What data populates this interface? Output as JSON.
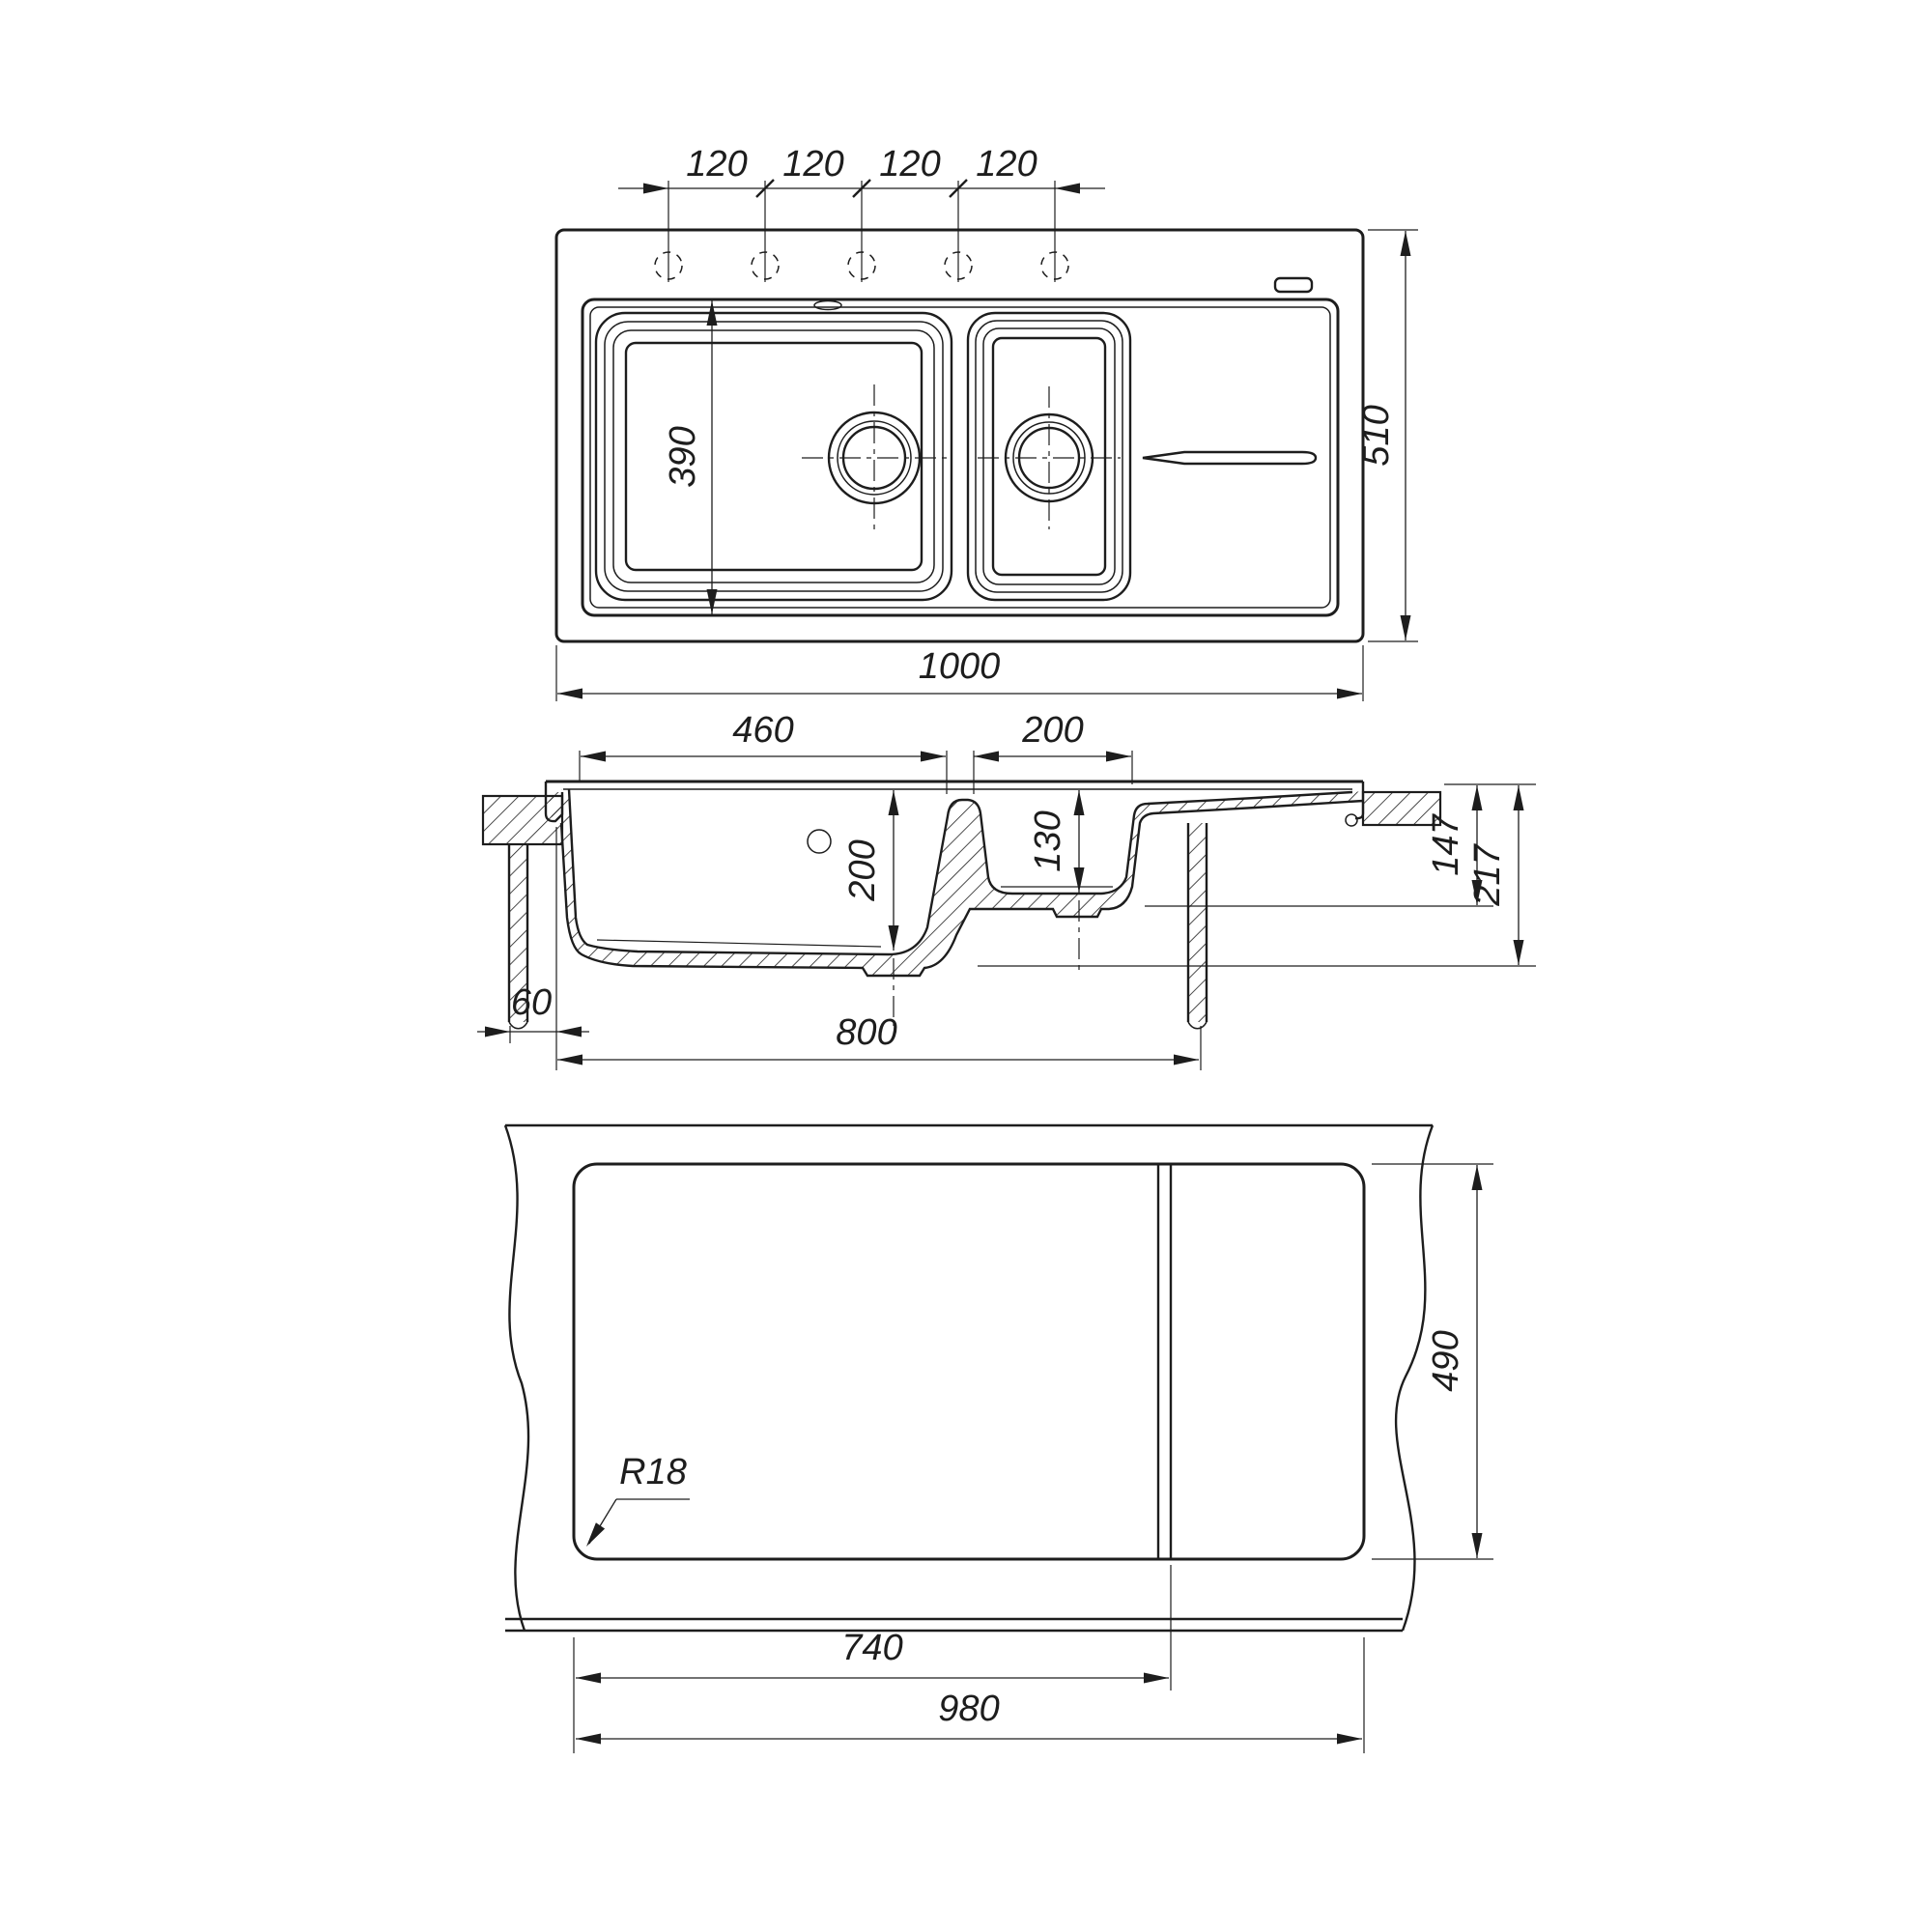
{
  "drawing": {
    "background": "#ffffff",
    "line_color": "#1d1d1d",
    "views": {
      "top": {
        "label": "top-view",
        "hole_spacings": [
          "120",
          "120",
          "120",
          "120"
        ],
        "bowl_recess_depth": "390",
        "overall_depth": "510",
        "overall_width": "1000"
      },
      "section": {
        "label": "section-view",
        "main_bowl_width": "460",
        "small_bowl_width": "200",
        "main_bowl_depth": "200",
        "small_bowl_depth": "130",
        "edge_offset": "60",
        "cabinet_width": "800",
        "height_to_small_bowl": "147",
        "height_to_main_bowl": "217"
      },
      "cutout": {
        "label": "cutout-view",
        "corner_radius": "R18",
        "step_width": "740",
        "cutout_width": "980",
        "cutout_depth": "490"
      }
    }
  }
}
